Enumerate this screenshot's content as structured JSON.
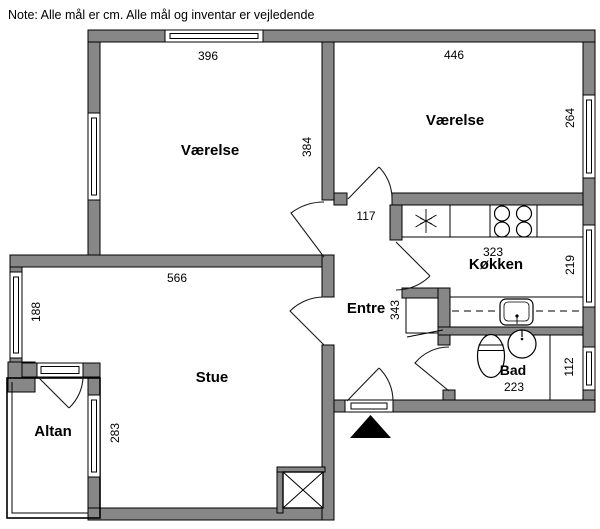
{
  "note": "Note: Alle mål er cm. Alle mål og inventar er vejledende",
  "rooms": {
    "vaerelse1": {
      "label": "Værelse",
      "dim_width": "396",
      "dim_depth": "384"
    },
    "vaerelse2": {
      "label": "Værelse",
      "dim_width": "446",
      "dim_depth": "264"
    },
    "koekken": {
      "label": "Køkken",
      "dim_width": "323",
      "dim_depth": "219"
    },
    "entre": {
      "label": "Entre",
      "dim_hall_width": "117",
      "dim_depth": "343"
    },
    "stue": {
      "label": "Stue",
      "dim_width": "566",
      "dim_alcove_depth": "188",
      "dim_west_depth": "283"
    },
    "bad": {
      "label": "Bad",
      "dim_width": "223",
      "dim_depth": "112"
    },
    "altan": {
      "label": "Altan"
    }
  },
  "colors": {
    "wall_fill": "#878787",
    "wall_outline": "#000000",
    "background": "#ffffff"
  }
}
